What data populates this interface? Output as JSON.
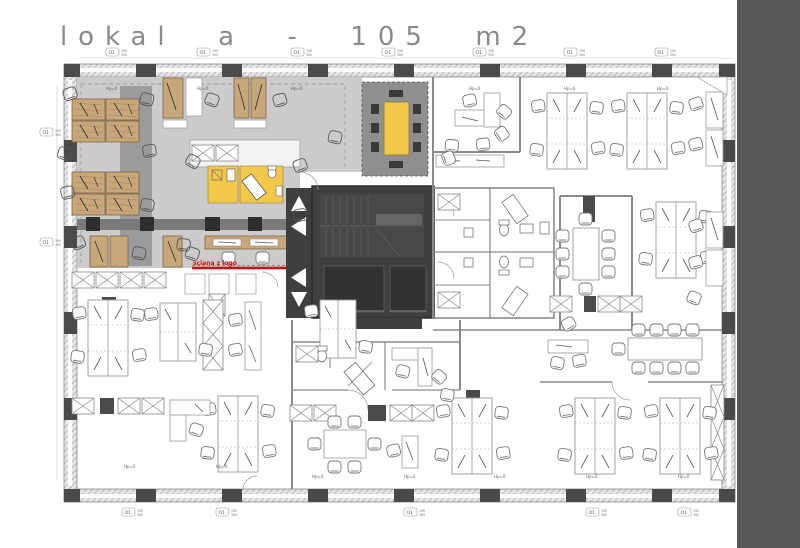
{
  "title": {
    "text": "lokal a - 105 m2"
  },
  "labels": {
    "wall_logo": "ściana z logo",
    "parapet": "Hp=0",
    "window_tag": "O1",
    "window_width": "190",
    "window_height": "300"
  },
  "colors": {
    "zone_fill": "#cbcbcb",
    "zone_inner_strip": "#9b9b9b",
    "corridor_band": "#7a7a7a",
    "core_fill": "#3f3f3f",
    "elevator_fill": "#323232",
    "accent_yellow": "#f2c84b",
    "wood": "#c7a67a",
    "logo_red": "#cc1111",
    "margin_bar": "#575759",
    "title_text": "#8a8a8a",
    "wall_dark": "#4a4a4a",
    "furniture_line": "#999999"
  }
}
